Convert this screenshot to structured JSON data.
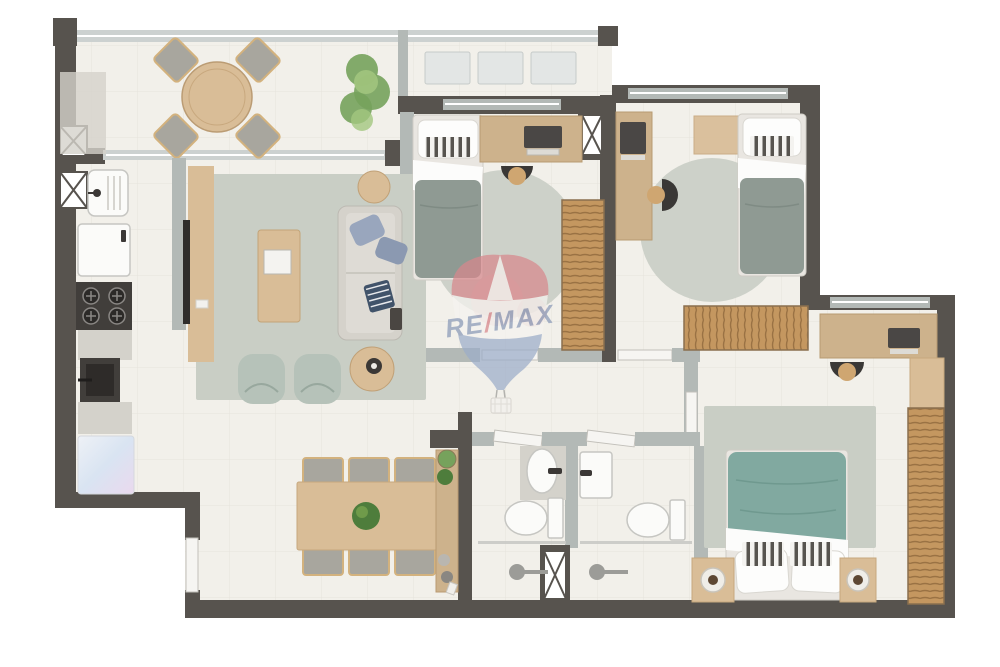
{
  "watermark": {
    "re": "RE",
    "slash": "/",
    "max": "MAX"
  },
  "colors": {
    "bg": "#ffffff",
    "floor": "#f2f0ea",
    "floorLine": "#e6e3dc",
    "wallDark": "#57534e",
    "wallLight": "#b3b9b6",
    "railing": "#ccd1d0",
    "door": "#f6f5f2",
    "wood": "#d9bd97",
    "woodDark": "#c19a6b",
    "woodDesk": "#cdb28c",
    "slat": "#c49760",
    "slatLine": "#9a7244",
    "concrete": "#d4d2cb",
    "appliance": "#413e3b",
    "rugGray": "#c9cec5",
    "rugRound": "#cdd1c9",
    "sofa": "#d5d2cb",
    "sage": "#b6c2b9",
    "duvetGray": "#8f9a93",
    "duvetTeal": "#81a9a0",
    "pillowBlue": "#99a6bd",
    "navy": "#41536a",
    "plant": "#76a25c",
    "plantDark": "#4e7d3c",
    "chairGray": "#a8a69e",
    "chairTrim": "#d3b27e",
    "fixture": "#fbfbf9",
    "fixtureLine": "#c6c6c2",
    "lampDark": "#5d4733",
    "glass": "#c9c9c5",
    "remaxRed": "#d8888d",
    "remaxBlue": "#9cadc9",
    "remaxText": "#8a99b8",
    "remaxWhite": "#f6f4f0"
  },
  "floorplan": {
    "type": "apartment-top-view-3d-render",
    "rooms": [
      {
        "name": "balcony-terrace",
        "furniture": [
          "round-table",
          "chair-x4",
          "large-plant",
          "floor-mat"
        ]
      },
      {
        "name": "technical-ledge",
        "furniture": [
          "ac-unit-1",
          "ac-unit-2",
          "ac-unit-3"
        ]
      },
      {
        "name": "kitchen",
        "furniture": [
          "laundry-sink",
          "washing-machine",
          "cooktop-4-burners",
          "counter",
          "dark-sink",
          "refrigerator"
        ]
      },
      {
        "name": "living-room",
        "furniture": [
          "tv-console",
          "tv",
          "area-rug",
          "coffee-table-with-tray",
          "sofa",
          "side-table-small",
          "side-table-large",
          "armchair-x2"
        ]
      },
      {
        "name": "dining-room",
        "furniture": [
          "dining-table",
          "dining-chair-x6",
          "centerpiece-plant",
          "sideboard",
          "sideboard-plants"
        ]
      },
      {
        "name": "bedroom-1",
        "furniture": [
          "single-bed",
          "desk-with-laptop",
          "desk-chair",
          "round-rug",
          "wardrobe"
        ]
      },
      {
        "name": "bedroom-2",
        "furniture": [
          "single-bed",
          "desk-with-laptop",
          "desk-chair",
          "round-rug",
          "wardrobe",
          "wall-shelf"
        ]
      },
      {
        "name": "master-bedroom",
        "furniture": [
          "double-bed",
          "nightstand-x2",
          "lamp-x2",
          "area-rug",
          "desk-with-laptop",
          "desk-chair",
          "wardrobe",
          "cabinet"
        ]
      },
      {
        "name": "bathroom-1",
        "furniture": [
          "oval-sink",
          "toilet",
          "shower"
        ]
      },
      {
        "name": "bathroom-2",
        "furniture": [
          "square-sink",
          "toilet",
          "shower"
        ]
      },
      {
        "name": "hallway",
        "furniture": [
          "door-bedroom-1",
          "door-bedroom-2",
          "door-master",
          "door-bath-1",
          "door-bath-2",
          "entry-door"
        ]
      }
    ]
  }
}
